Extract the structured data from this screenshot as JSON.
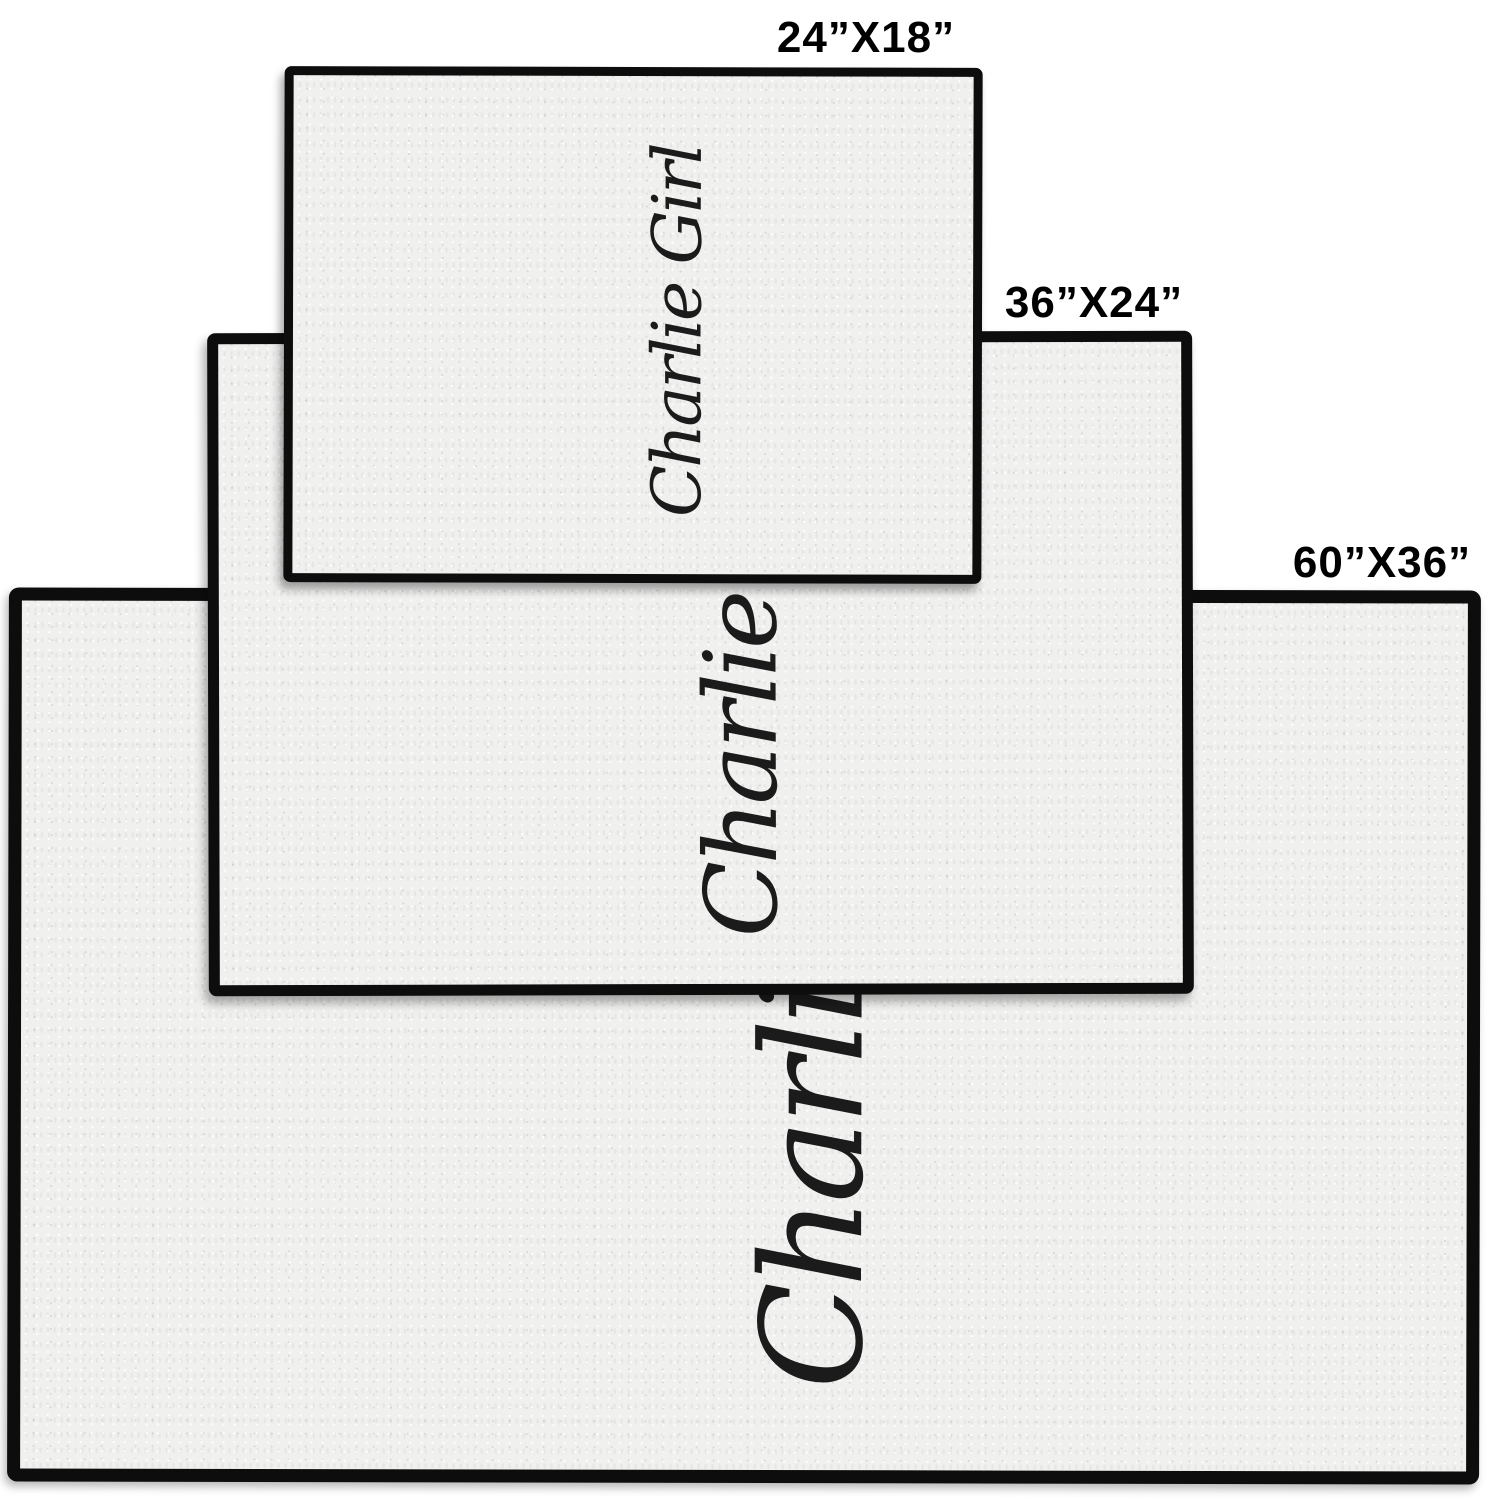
{
  "personalization": {
    "text": "Charlie Girl",
    "text_color": "#1b1b1b",
    "orientation": "rotated-90-ccw"
  },
  "mats": [
    {
      "name": "small",
      "size_label": "24”X18”",
      "width_inches": 24,
      "height_inches": 18
    },
    {
      "name": "medium",
      "size_label": "36”X24”",
      "width_inches": 36,
      "height_inches": 24
    },
    {
      "name": "large",
      "size_label": "60”X36”",
      "width_inches": 60,
      "height_inches": 36
    }
  ],
  "colors": {
    "page_background": "#ffffff",
    "mat_surface": "#f0f0ef",
    "mat_border": "#0d0d0d",
    "label_text": "#000000"
  }
}
